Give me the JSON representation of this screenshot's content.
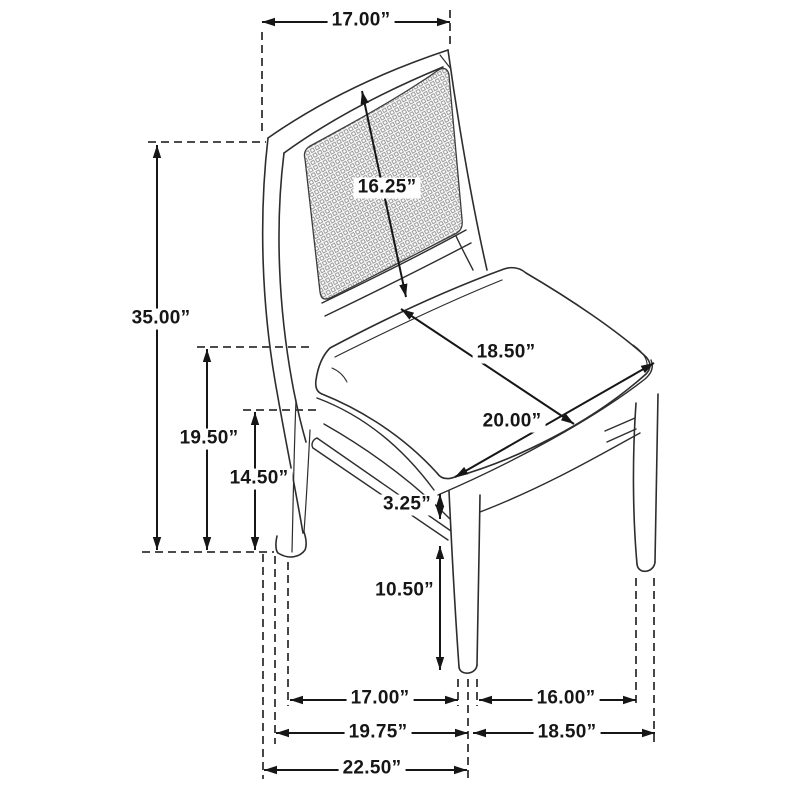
{
  "diagram": {
    "type": "product-dimension-line-drawing",
    "subject": "dining side chair with cane back panel and upholstered seat",
    "unit": "inches",
    "line_color": "#1a1a1a",
    "pattern": "cane-mesh-grid",
    "dimensions": {
      "back_top_width": "17.00”",
      "overall_height": "35.00”",
      "back_panel_diagonal": "16.25”",
      "floor_to_seat_top": "19.50”",
      "floor_to_stretcher": "14.50”",
      "seat_depth": "18.50”",
      "seat_width": "20.00”",
      "apron_thickness": "3.25”",
      "front_leg_height": "10.50”",
      "front_leg_spacing": "17.00”",
      "side_leg_spacing": "16.00”",
      "base_width_mid": "19.75”",
      "base_depth_mid": "18.50”",
      "overall_width": "22.50”"
    }
  }
}
